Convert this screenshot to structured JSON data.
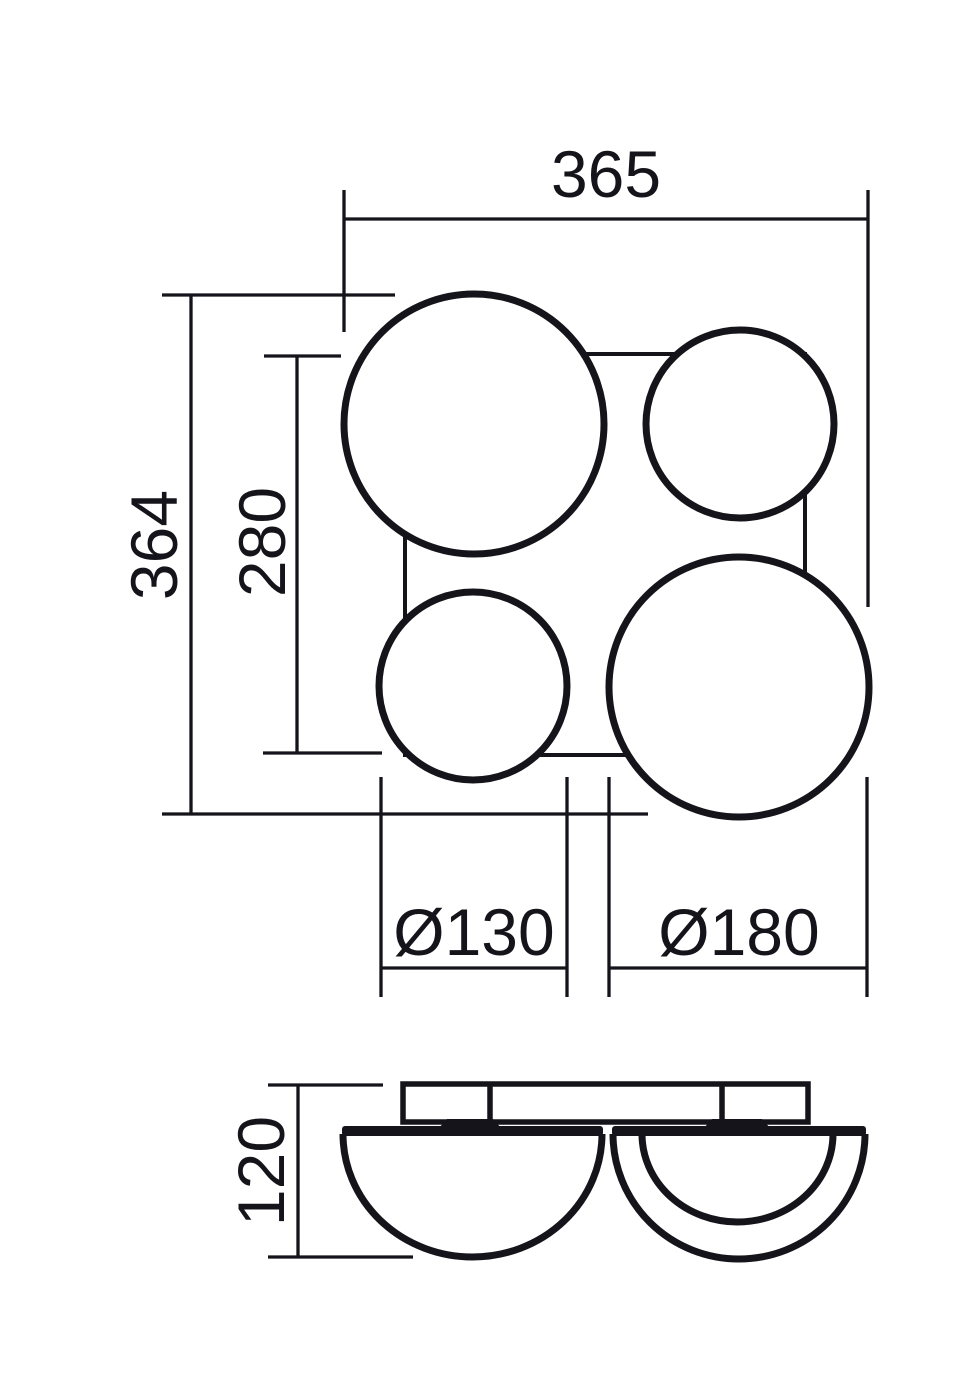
{
  "drawing": {
    "type": "technical-dimension-drawing",
    "subject": "four-globe ceiling light fixture",
    "background_color": "#ffffff",
    "line_color": "#14141a",
    "views": {
      "plan": "top view with square canopy and four globes",
      "side": "front elevation with mounting plate and two visible domes"
    },
    "dims": {
      "plan_width": "365",
      "plan_height": "364",
      "canopy_size": "280",
      "small_globe_diameter": "Ø130",
      "large_globe_diameter": "Ø180",
      "side_height": "120"
    }
  }
}
